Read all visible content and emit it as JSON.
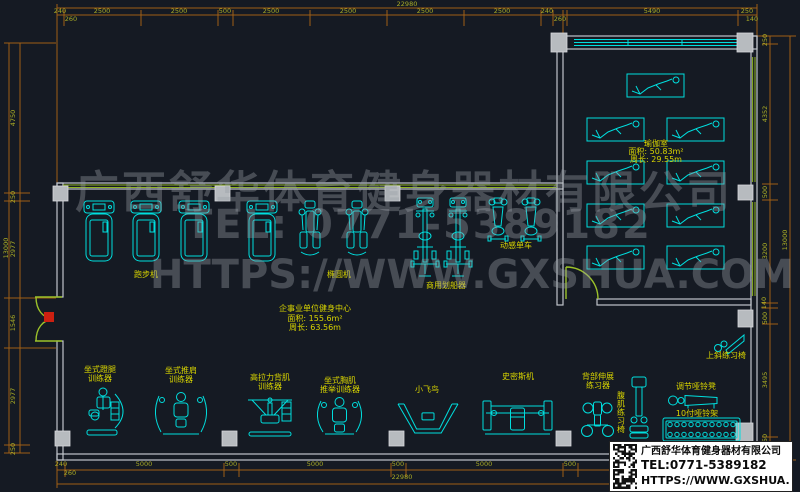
{
  "colors": {
    "background": "#151a23",
    "equipment": "#00dede",
    "label": "#d8d400",
    "dimension_line": "#a05f16",
    "dimension_text": "#a8ab25",
    "wall": "#c0c5cb",
    "window_green": "#8fb322",
    "door_green": "#9cc22a",
    "door_red": "#cc2011",
    "pilaster": "#b7bbbf",
    "watermark": "#989ea5",
    "titlebox_bg": "#ffffff",
    "titlebox_text": "#0b0b0b"
  },
  "watermark": {
    "company": "广西舒华体育健身器材有限公司",
    "tel": "TEL: 0771-5389182",
    "url": "HTTPS://WWW.GXSHUA.COM"
  },
  "title_block": {
    "company": "广西舒华体育健身器材有限公司",
    "tel": "TEL:0771-5389182",
    "url": "HTTPS://WWW.GXSHUA.COM"
  },
  "rooms": {
    "gym": {
      "name": "企事业单位健身中心",
      "area": "面积: 155.6m²",
      "perimeter": "周长: 63.56m"
    },
    "yoga": {
      "name": "瑜伽室",
      "area": "面积: 50.83m²",
      "perimeter": "周长: 29.55m"
    }
  },
  "dim_labels": [
    {
      "t": "22980",
      "x": 407,
      "y": 6
    },
    {
      "t": "240",
      "x": 60,
      "y": 13
    },
    {
      "t": "260",
      "x": 71,
      "y": 21
    },
    {
      "t": "2500",
      "x": 102,
      "y": 13
    },
    {
      "t": "2500",
      "x": 179,
      "y": 13
    },
    {
      "t": "500",
      "x": 225,
      "y": 13
    },
    {
      "t": "2500",
      "x": 271,
      "y": 13
    },
    {
      "t": "2500",
      "x": 348,
      "y": 13
    },
    {
      "t": "2500",
      "x": 425,
      "y": 13
    },
    {
      "t": "2500",
      "x": 502,
      "y": 13
    },
    {
      "t": "240",
      "x": 547,
      "y": 13
    },
    {
      "t": "260",
      "x": 560,
      "y": 21
    },
    {
      "t": "5490",
      "x": 652,
      "y": 13
    },
    {
      "t": "250",
      "x": 747,
      "y": 13
    },
    {
      "t": "140",
      "x": 752,
      "y": 21
    },
    {
      "t": "240",
      "x": 61,
      "y": 466
    },
    {
      "t": "260",
      "x": 70,
      "y": 475
    },
    {
      "t": "5000",
      "x": 144,
      "y": 466
    },
    {
      "t": "500",
      "x": 231,
      "y": 466
    },
    {
      "t": "5000",
      "x": 315,
      "y": 466
    },
    {
      "t": "500",
      "x": 398,
      "y": 466
    },
    {
      "t": "5000",
      "x": 484,
      "y": 466
    },
    {
      "t": "500",
      "x": 570,
      "y": 466
    },
    {
      "t": "22980",
      "x": 402,
      "y": 479
    },
    {
      "t": "13000",
      "x": 8,
      "y": 248,
      "r": -90
    },
    {
      "t": "4750",
      "x": 15,
      "y": 118,
      "r": -90
    },
    {
      "t": "250",
      "x": 15,
      "y": 197,
      "r": -90
    },
    {
      "t": "2977",
      "x": 15,
      "y": 249,
      "r": -90
    },
    {
      "t": "1546",
      "x": 15,
      "y": 323,
      "r": -90
    },
    {
      "t": "2977",
      "x": 15,
      "y": 396,
      "r": -90
    },
    {
      "t": "250",
      "x": 15,
      "y": 449,
      "r": -90
    },
    {
      "t": "250",
      "x": 767,
      "y": 40,
      "r": -90
    },
    {
      "t": "4352",
      "x": 767,
      "y": 114,
      "r": -90
    },
    {
      "t": "500",
      "x": 767,
      "y": 192,
      "r": -90
    },
    {
      "t": "3200",
      "x": 767,
      "y": 251,
      "r": -90
    },
    {
      "t": "140",
      "x": 766,
      "y": 303,
      "r": -90
    },
    {
      "t": "500",
      "x": 767,
      "y": 318,
      "r": -90
    },
    {
      "t": "3495",
      "x": 767,
      "y": 380,
      "r": -90
    },
    {
      "t": "150",
      "x": 767,
      "y": 440,
      "r": -90
    },
    {
      "t": "13000",
      "x": 787,
      "y": 240,
      "r": -90
    }
  ],
  "equipment_labels": [
    {
      "text": "跑步机",
      "x": 146,
      "y": 277
    },
    {
      "text": "椭圆机",
      "x": 339,
      "y": 277
    },
    {
      "text": "商用划船器",
      "x": 446,
      "y": 288
    },
    {
      "text": "动感单车",
      "x": 516,
      "y": 248
    },
    {
      "text": "坐式蹬腿",
      "x": 100,
      "y": 372
    },
    {
      "text": "训练器",
      "x": 100,
      "y": 381
    },
    {
      "text": "坐式推肩",
      "x": 181,
      "y": 373
    },
    {
      "text": "训练器",
      "x": 181,
      "y": 382
    },
    {
      "text": "高拉力背肌",
      "x": 270,
      "y": 380
    },
    {
      "text": "训练器",
      "x": 270,
      "y": 389
    },
    {
      "text": "坐式胸肌",
      "x": 340,
      "y": 383
    },
    {
      "text": "推举训练器",
      "x": 340,
      "y": 392
    },
    {
      "text": "小飞鸟",
      "x": 427,
      "y": 392
    },
    {
      "text": "史密斯机",
      "x": 518,
      "y": 379
    },
    {
      "text": "背部伸展",
      "x": 598,
      "y": 379
    },
    {
      "text": "练习器",
      "x": 598,
      "y": 388
    },
    {
      "text": "腹肌练习椅",
      "x": 621,
      "y": 398,
      "vertical": true
    },
    {
      "text": "调节哑铃凳",
      "x": 696,
      "y": 389
    },
    {
      "text": "10付哑铃架",
      "x": 697,
      "y": 416
    },
    {
      "text": "上斜练习椅",
      "x": 726,
      "y": 358
    }
  ],
  "equipment": [
    {
      "type": "treadmill",
      "cx": 99
    },
    {
      "type": "treadmill",
      "cx": 146
    },
    {
      "type": "treadmill",
      "cx": 194
    },
    {
      "type": "treadmill",
      "cx": 262
    },
    {
      "type": "elliptical",
      "cx": 310
    },
    {
      "type": "elliptical",
      "cx": 357
    },
    {
      "type": "rower",
      "cx": 425
    },
    {
      "type": "rower",
      "cx": 458
    },
    {
      "type": "spinbike",
      "cx": 498
    },
    {
      "type": "spinbike",
      "cx": 531
    },
    {
      "type": "leg-press-machine",
      "x": 85,
      "y": 386,
      "w": 44,
      "h": 52
    },
    {
      "type": "shoulder-press-machine",
      "x": 153,
      "y": 390,
      "w": 56,
      "h": 48
    },
    {
      "type": "lat-pulldown-machine",
      "x": 245,
      "y": 395,
      "w": 50,
      "h": 43
    },
    {
      "type": "chest-press-machine",
      "x": 315,
      "y": 395,
      "w": 49,
      "h": 43
    },
    {
      "type": "fly-bird-machine",
      "x": 398,
      "y": 402,
      "w": 60,
      "h": 31
    },
    {
      "type": "smith-machine",
      "x": 483,
      "y": 397,
      "w": 69,
      "h": 39
    },
    {
      "type": "back-extension-machine",
      "x": 580,
      "y": 399,
      "w": 35,
      "h": 39
    },
    {
      "type": "ab-chair",
      "x": 629,
      "y": 377,
      "w": 20,
      "h": 61
    },
    {
      "type": "dumbbell-bench",
      "x": 668,
      "y": 392,
      "w": 52,
      "h": 17
    },
    {
      "type": "dumbbell-rack",
      "x": 663,
      "y": 418,
      "w": 77,
      "h": 23
    },
    {
      "type": "incline-chair",
      "x": 714,
      "y": 334,
      "w": 32,
      "h": 19
    }
  ],
  "yoga_mats": [
    [
      627,
      74
    ],
    [
      587,
      118
    ],
    [
      667,
      118
    ],
    [
      587,
      161
    ],
    [
      667,
      161
    ],
    [
      587,
      204
    ],
    [
      667,
      204
    ],
    [
      587,
      246
    ],
    [
      667,
      246
    ]
  ]
}
